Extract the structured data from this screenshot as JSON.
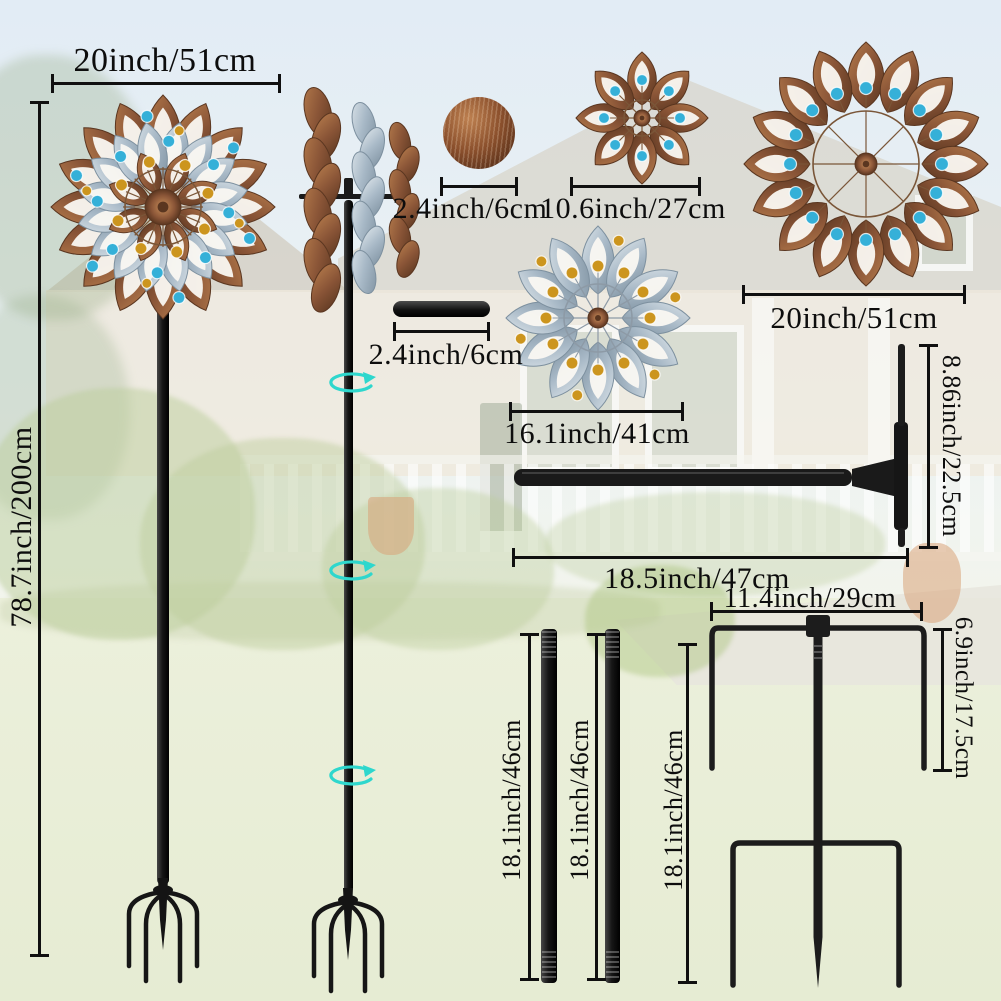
{
  "colors": {
    "dimension_ink": "#101010",
    "metal_black": "#1b1b1b",
    "bronze": "#8a5537",
    "bronze_light": "#b67c4c",
    "bronze_dark": "#5a3620",
    "copper_light": "#c98f5a",
    "silver_blue": "#a7b8c6",
    "silver_light": "#dde5ea",
    "silver_dark": "#7d909f",
    "bead_blue": "#35b0d8",
    "bead_amber": "#cc951e",
    "rotation_teal": "#2ed7cd"
  },
  "annotations": {
    "spinner_total_width": "20inch/51cm",
    "spinner_total_height": "78.7inch/200cm",
    "ball_cap_diameter": "2.4inch/6cm",
    "small_flower_diameter": "10.6inch/27cm",
    "large_spinner_diameter": "20inch/51cm",
    "connector_length": "2.4inch/6cm",
    "medium_spinner_diameter": "16.1inch/41cm",
    "tbar_height": "8.86inch/22.5cm",
    "tbar_length": "18.5inch/47cm",
    "stake_width": "11.4inch/29cm",
    "stake_upper_prong_height": "6.9inch/17.5cm",
    "pole_section_1_length": "18.1inch/46cm",
    "pole_section_2_length": "18.1inch/46cm",
    "ground_stake_height": "18.1inch/46cm"
  },
  "icons": {
    "rotation_arrow": "⟳"
  }
}
